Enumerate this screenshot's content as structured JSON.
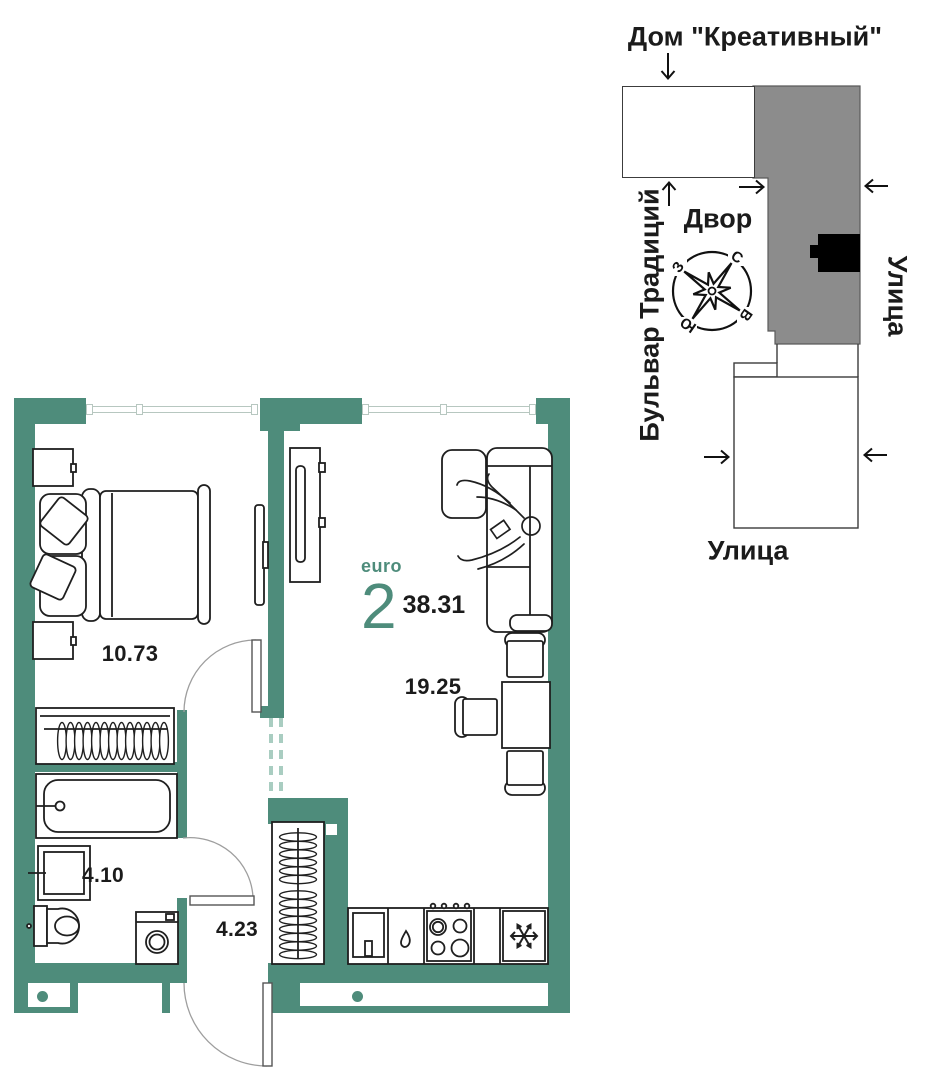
{
  "plan": {
    "type_label": "euro",
    "rooms_count": "2",
    "total_area": "38.31",
    "areas": {
      "bedroom": "10.73",
      "living": "19.25",
      "bathroom": "4.10",
      "hallway": "4.23"
    }
  },
  "map": {
    "title": "Дом \"Креативный\"",
    "yard_label": "Двор",
    "boulevard_label": "Бульвар Традиций",
    "street_right_label": "Улица",
    "street_bottom_label": "Улица",
    "compass": {
      "n": "С",
      "e": "В",
      "s": "Ю",
      "w": "З"
    }
  },
  "colors": {
    "wall_teal": "#4e8c7b",
    "building_gray": "#8c8c8c",
    "unit_marker": "#000000",
    "ink": "#1b1b1b"
  }
}
